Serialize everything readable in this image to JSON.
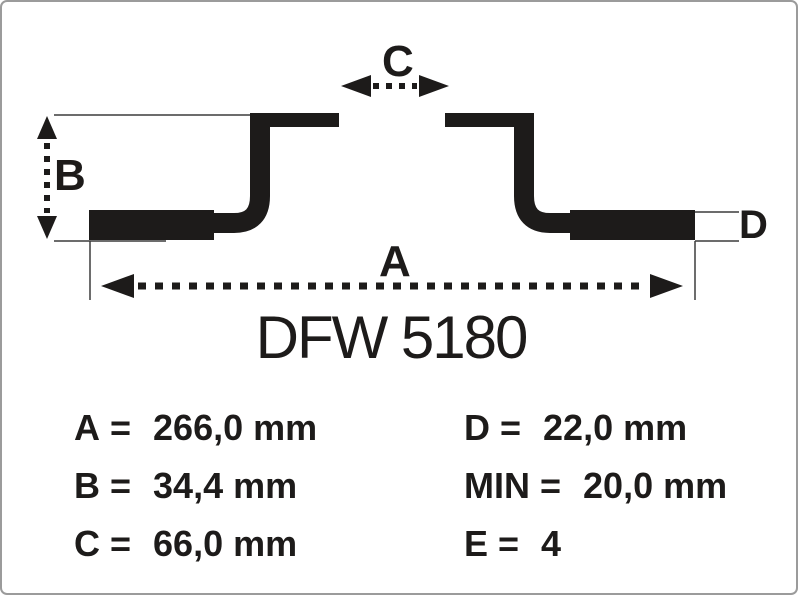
{
  "part": {
    "title": "DFW 5180"
  },
  "diagram": {
    "type": "brake-disc-cross-section",
    "labels": {
      "a": "A",
      "b": "B",
      "c": "C",
      "d": "D"
    }
  },
  "specs": {
    "eq": "=",
    "left": [
      {
        "label": "A",
        "value": "266,0 mm"
      },
      {
        "label": "B",
        "value": "34,4 mm"
      },
      {
        "label": "C",
        "value": "66,0 mm"
      }
    ],
    "right": [
      {
        "label": "D",
        "value": "22,0 mm"
      },
      {
        "label": "MIN",
        "value": "20,0 mm"
      },
      {
        "label": "E",
        "value": "4"
      }
    ]
  },
  "colors": {
    "ink": "#1d1b1a",
    "line": "#3c3c3c",
    "border": "#9b9b9b",
    "background": "#ffffff"
  }
}
